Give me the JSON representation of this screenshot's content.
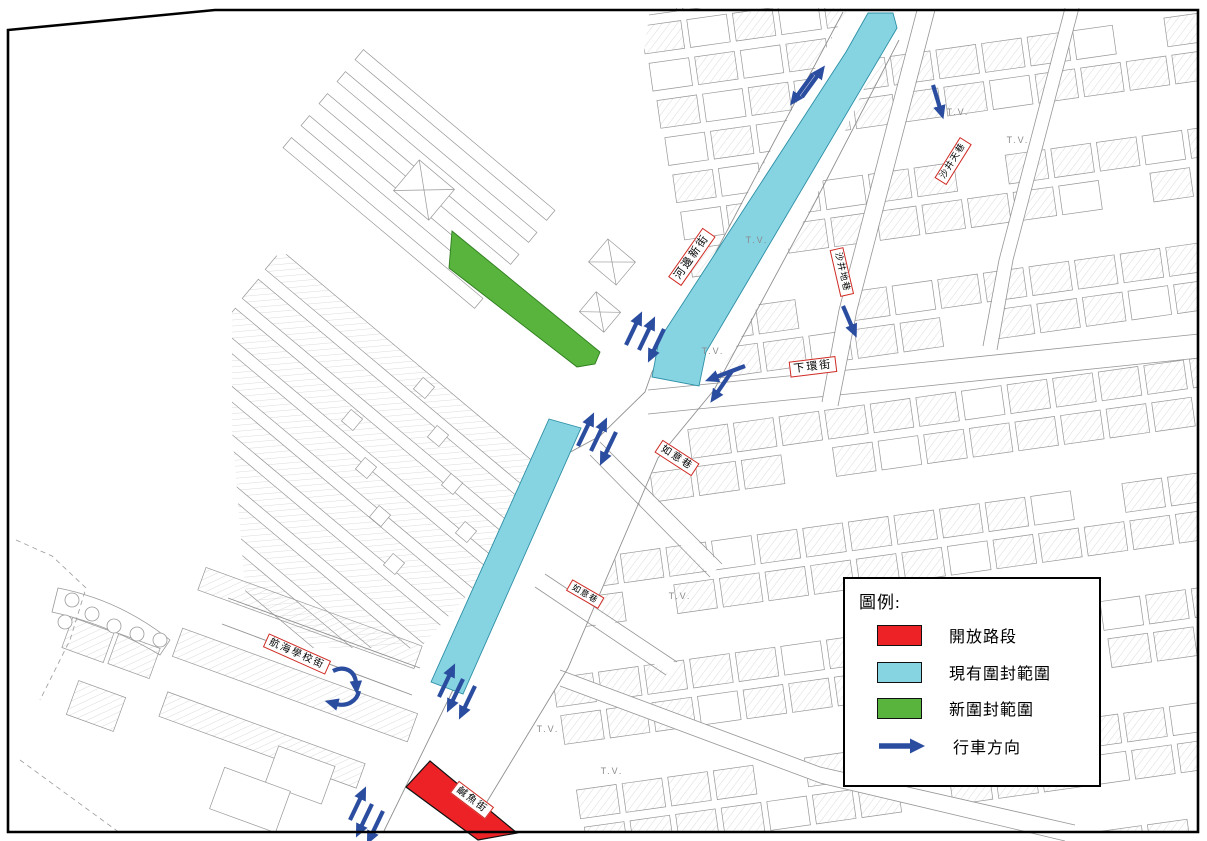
{
  "legend": {
    "title": "圖例:",
    "items": [
      {
        "id": "open-road",
        "label": "開放路段",
        "swatch": "red",
        "color": "#ec2227"
      },
      {
        "id": "existing-closure",
        "label": "現有圍封範圍",
        "swatch": "cyan",
        "color": "#86d3e2"
      },
      {
        "id": "new-closure",
        "label": "新圍封範圍",
        "swatch": "green",
        "color": "#58b43d"
      },
      {
        "id": "traffic-direction",
        "label": "行車方向",
        "swatch": "arrow",
        "color": "#2b4da0"
      }
    ]
  },
  "street_labels": [
    {
      "name": "河邊新街"
    },
    {
      "name": "沙井天巷"
    },
    {
      "name": "沙井地巷"
    },
    {
      "name": "下環街"
    },
    {
      "name": "如意巷"
    },
    {
      "name": "如意巷"
    },
    {
      "name": "航海學校街"
    },
    {
      "name": "鹹魚街"
    }
  ],
  "map_text": {
    "vacant_lot": "T.V."
  },
  "colors": {
    "open_road": "#ec2227",
    "existing_closure": "#86d3e2",
    "new_closure": "#58b43d",
    "arrow": "#2b4da0",
    "street_label_border": "#cf2b24",
    "frame": "#000000"
  }
}
